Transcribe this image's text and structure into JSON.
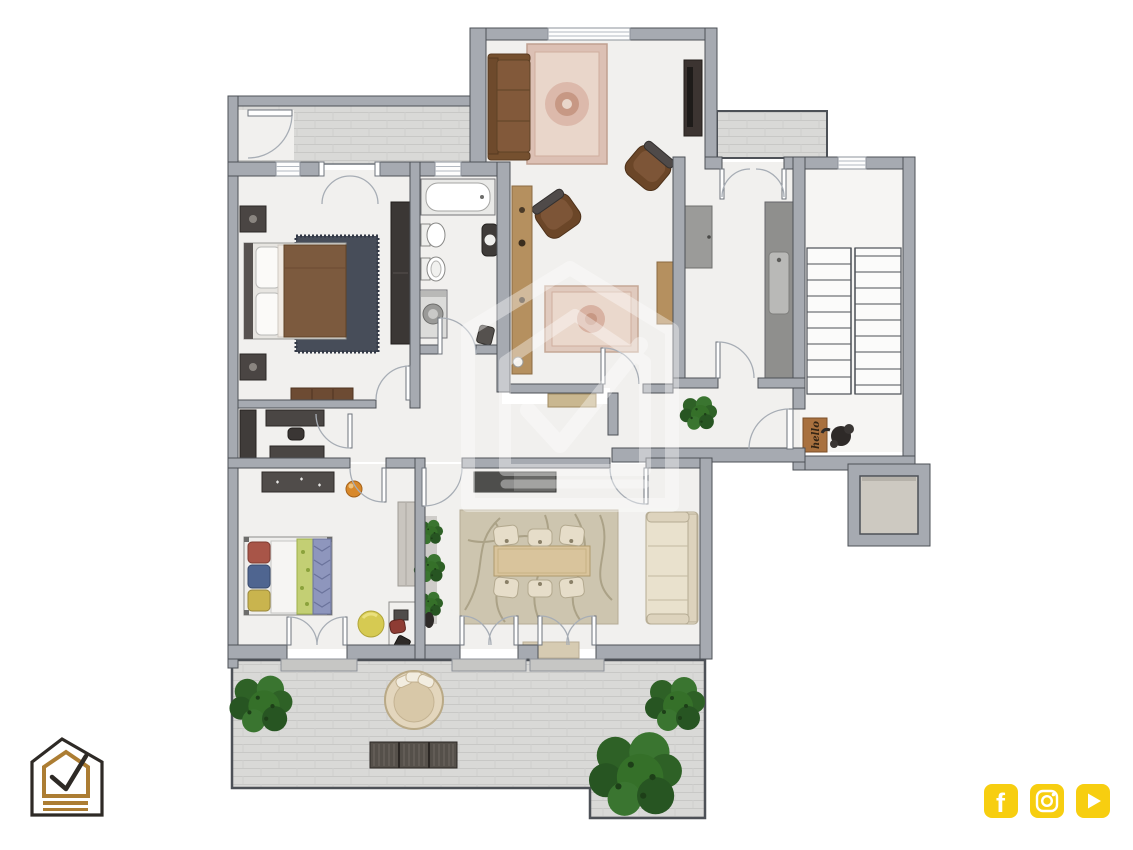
{
  "page": {
    "background": "#ffffff",
    "kind": "rendered 2D apartment floor plan, top view, no text labels"
  },
  "colors": {
    "bg": "#ffffff",
    "wall": "#a6aab1",
    "wallStroke": "#4d5157",
    "floor": "#f1f0ee",
    "tile": "#d9d9d7",
    "tileLine": "#c8c8c6",
    "stairFloor": "#f6f5f3",
    "darkFurniture": "#423e3b",
    "wood": "#b5905f",
    "woodSofa": "#82593a",
    "rugPink": "#dcc0b4",
    "rugPinkInner": "#e9d6ca",
    "bedBlanket": "#7c5a3e",
    "rugDark": "#474d59",
    "kidsGreen": "#c3cf74",
    "kidsBlue": "#8e96bd",
    "kidsRed": "#a85548",
    "pouf": "#d6ca52",
    "ballOrange": "#d8882a",
    "diningRug": "#cdc5af",
    "diningSwirl": "#a79d83",
    "tableWood": "#d9c49c",
    "chairCream": "#e6ddc9",
    "sofaCream": "#e9e1cd",
    "plantGreen": "#3a7530",
    "matBrown": "#a9713f",
    "helloText": "#332414",
    "accentYellow": "#f7ce10",
    "logoGold": "#ac7d33",
    "logoDark": "#2e2a26"
  },
  "floor_plan": {
    "doormat_text": "hello",
    "rooms": [
      {
        "name": "living-room",
        "furniture": [
          "brown-sofa",
          "oriental-rug",
          "tv-cabinet",
          "armchair",
          "armchair",
          "wood-sideboard",
          "wood-console",
          "small-oriental-rug"
        ]
      },
      {
        "name": "master-bedroom",
        "furniture": [
          "double-bed",
          "dark-rug",
          "nightstand",
          "nightstand",
          "wardrobe",
          "dresser"
        ]
      },
      {
        "name": "bathroom",
        "furniture": [
          "bathtub",
          "bidet",
          "toilet",
          "washing-machine",
          "wall-sink"
        ]
      },
      {
        "name": "kitchen",
        "furniture": [
          "tall-cabinet",
          "counter-with-sink"
        ]
      },
      {
        "name": "dressing-study",
        "furniture": [
          "wardrobe",
          "desk",
          "desk",
          "chair"
        ]
      },
      {
        "name": "kids-bedroom",
        "furniture": [
          "single-bed",
          "wall-shelf",
          "wardrobe",
          "desk-with-chair",
          "stool",
          "yellow-pouf",
          "orange-ball"
        ]
      },
      {
        "name": "dining-room",
        "furniture": [
          "dining-table",
          "six-chairs",
          "swirl-rug",
          "sectional-sofa",
          "media-sideboard",
          "plant-shelf",
          "doormat"
        ]
      },
      {
        "name": "hallway",
        "furniture": [
          "bench",
          "plant"
        ]
      },
      {
        "name": "stairwell",
        "furniture": [
          "double-flight-stairs",
          "hello-doormat",
          "sculpture",
          "elevator"
        ]
      },
      {
        "name": "terrace",
        "furniture": [
          "round-daybed",
          "slatted-bench",
          "bush",
          "bush",
          "large-bush"
        ]
      },
      {
        "name": "balcony-top-left"
      },
      {
        "name": "balcony-top-right"
      }
    ]
  },
  "watermark": {
    "name": "house-checkmark-watermark",
    "opacity": 0.38
  },
  "branding": {
    "logo_name": "house-checkmark-logo"
  },
  "social": {
    "icons": [
      {
        "name": "facebook",
        "glyph": "f"
      },
      {
        "name": "instagram"
      },
      {
        "name": "youtube"
      }
    ]
  }
}
